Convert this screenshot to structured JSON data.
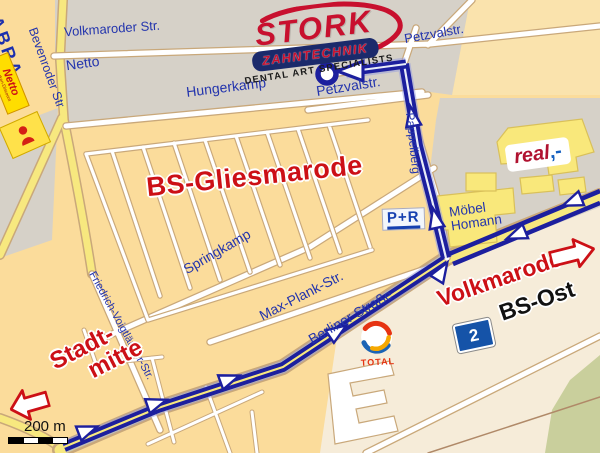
{
  "map": {
    "district_label": "BS-Gliesmarode",
    "streets": {
      "volkmaroder": "Volkmaroder Str.",
      "bevenroder": "Bevenroder Str",
      "hungerkamp": "Hungerkamp",
      "petzvalstr_top": "Petzvalstr.",
      "petzvalstr_main": "Petzvalstr.",
      "pappelberg": "Pappelberg",
      "springkamp": "Springkamp",
      "max_plank": "Max-Plank-Str.",
      "berliner": "Berliner Straße",
      "friedrich_voigtlaender": "Friedrich-Voigtländer-Str."
    },
    "places": {
      "abra": "ABRA",
      "netto": "Netto",
      "moebel_line1": "Möbel",
      "moebel_line2": "Homann",
      "park_ride": "P+R",
      "volkmarode": "Volkmarode",
      "bs_ost": "BS-Ost",
      "exit_number": "2",
      "stadtmitte_line1": "Stadt-",
      "stadtmitte_line2": "mitte"
    },
    "logos": {
      "stork": {
        "name": "STORK",
        "division": "ZAHNTECHNIK",
        "tagline": "DENTAL ART SPECIALISTS"
      },
      "real": {
        "name": "real",
        "suffix": ",-"
      },
      "netto_store": {
        "name": "Netto",
        "sub": "Marken-Discount"
      },
      "total": {
        "name": "TOTAL"
      }
    },
    "scale": {
      "label": "200 m"
    },
    "colors": {
      "route": "#1c1f9e",
      "street_text": "#2334ad",
      "highlight_red": "#cc1016",
      "area_grey": "#d6d1c8",
      "area_yellow": "#fbdc9b",
      "area_cream": "#f6ecd9"
    }
  }
}
